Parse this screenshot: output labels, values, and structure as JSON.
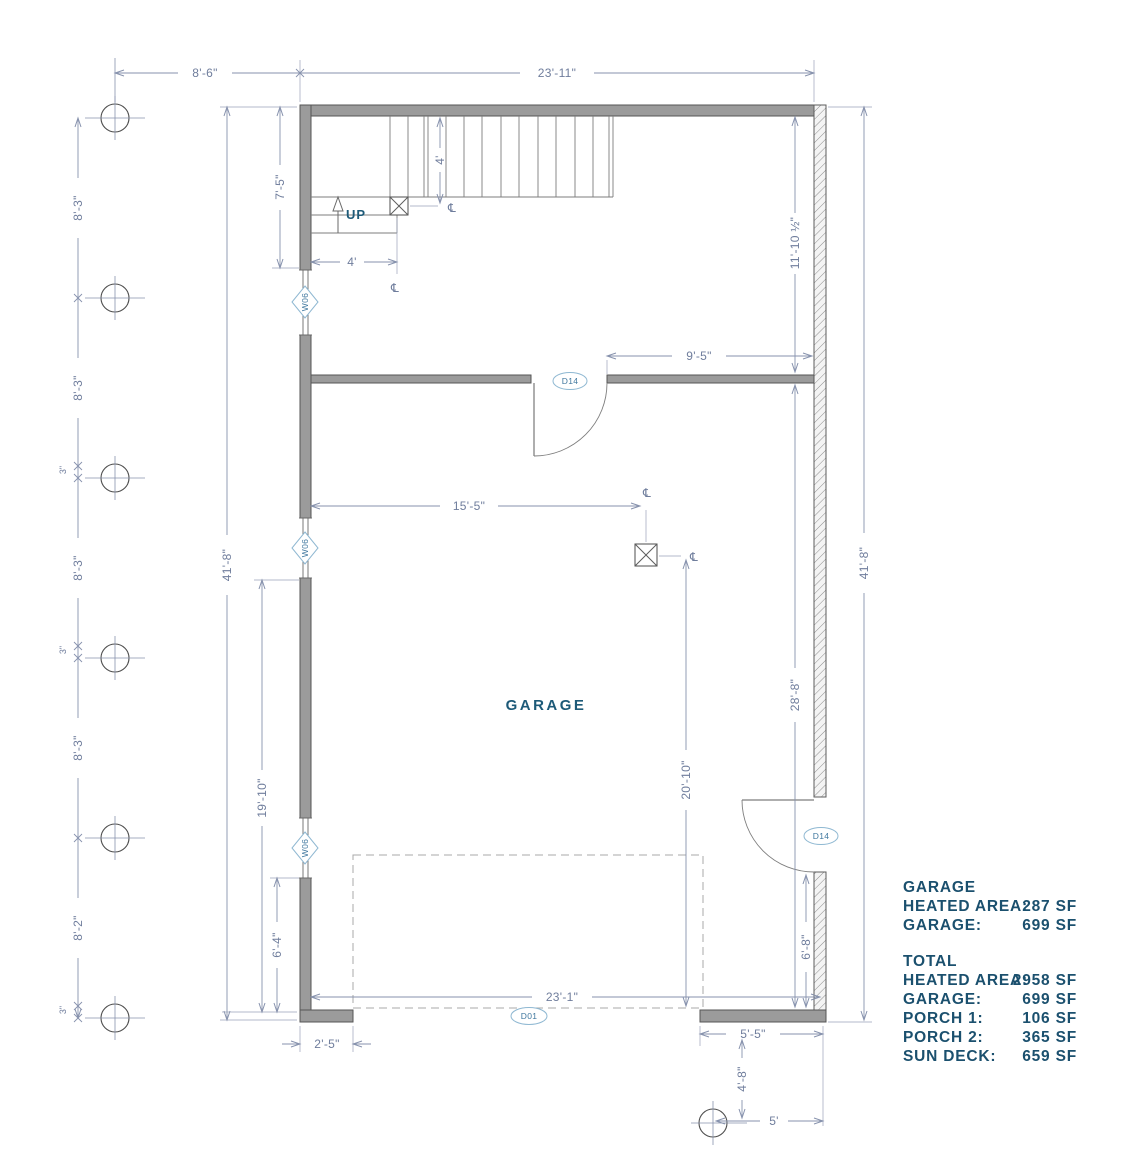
{
  "labels": {
    "room": "GARAGE",
    "up": "UP",
    "centerline": "℄"
  },
  "tags": {
    "window": "W06",
    "door": "D14",
    "garage_door": "D01"
  },
  "dims": {
    "top_left": "8'-6\"",
    "top_main": "23'-11\"",
    "left_seg": "8'-3\"",
    "left_seg_last": "8'-2\"",
    "offset_small": "3\"",
    "overall": "41'-8\"",
    "stair_depth": "7'-5\"",
    "stair_run": "4'",
    "upper_room": "11'-10 ½\"",
    "hall": "9'-5\"",
    "post_x": "15'-5\"",
    "post_front": "20'-10\"",
    "garage_depth": "28'-8\"",
    "left_lower": "19'-10\"",
    "win_bottom": "6'-4\"",
    "door_side": "6'-8\"",
    "front_right": "5'-5\"",
    "porch_depth": "4'-8\"",
    "porch_width": "5'",
    "garage_opening": "23'-1\"",
    "front_left": "2'-5\""
  },
  "summary": {
    "s1_title": "GARAGE",
    "rows1": [
      {
        "l": "HEATED AREA:",
        "v": "287 SF"
      },
      {
        "l": "GARAGE:",
        "v": "699 SF"
      }
    ],
    "s2_title": "TOTAL",
    "rows2": [
      {
        "l": "HEATED AREA:",
        "v": "2958 SF"
      },
      {
        "l": "GARAGE:",
        "v": "699 SF"
      },
      {
        "l": "PORCH 1:",
        "v": "106 SF"
      },
      {
        "l": "PORCH 2:",
        "v": "365 SF"
      },
      {
        "l": "SUN DECK:",
        "v": "659 SF"
      }
    ]
  },
  "colors": {
    "wall_fill": "#9b9b9b",
    "dim": "#6f7d9c",
    "annotation": "#1d5a78",
    "tag": "#41789f",
    "background": "#ffffff"
  }
}
